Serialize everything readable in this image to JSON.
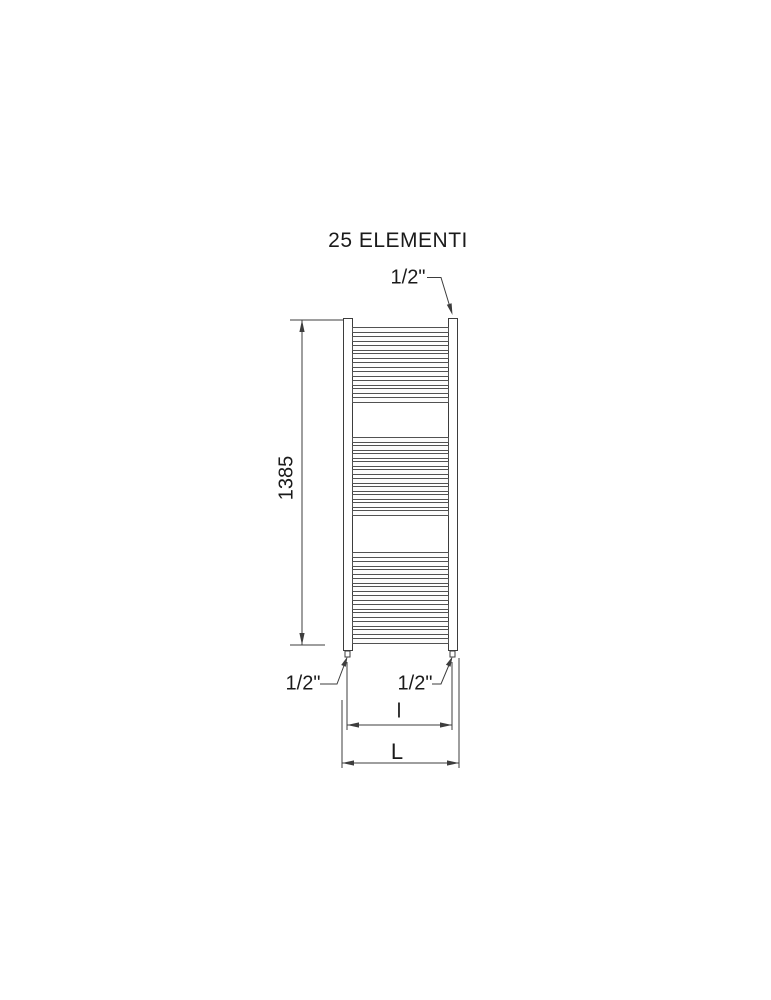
{
  "title": "25 ELEMENTI",
  "colors": {
    "line": "#3d3d3d",
    "text": "#1a1a1a",
    "background": "#ffffff"
  },
  "radiator": {
    "rung_groups": [
      9,
      10,
      11
    ],
    "element_count_label": "25 ELEMENTI"
  },
  "dimensions": {
    "height_value": "1385",
    "inner_width_label": "l",
    "outer_width_label": "L"
  },
  "connections": {
    "top_right": "1/2\"",
    "bottom_left": "1/2\"",
    "bottom_right": "1/2\""
  }
}
